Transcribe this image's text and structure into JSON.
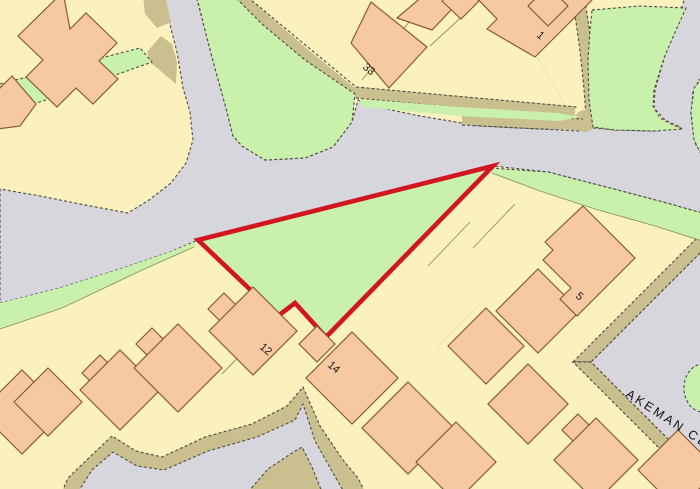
{
  "map": {
    "street_label": "AKEMAN CL",
    "house_numbers": {
      "h33": "33",
      "h1": "1",
      "h12": "12",
      "h14": "14",
      "h5": "5"
    },
    "selected_parcel": {
      "vertices": "198,240 278,316 295,303 326,337 493,166",
      "outline_color": "#d11523",
      "fill_color": "#c9f1ab"
    },
    "palette": {
      "road_gray": "#d7d6dd",
      "parcel_yellow": "#fbf1bd",
      "grass_green": "#c9f1ab",
      "footpath_khaki": "#c9bf8f",
      "building_fill": "#f7c9a0",
      "building_outline": "#8a5a36",
      "boundary_dash": "#53524a",
      "plot_line": "#8f8d64",
      "selection_red": "#d11523",
      "label_black": "#1c1c1c"
    }
  }
}
